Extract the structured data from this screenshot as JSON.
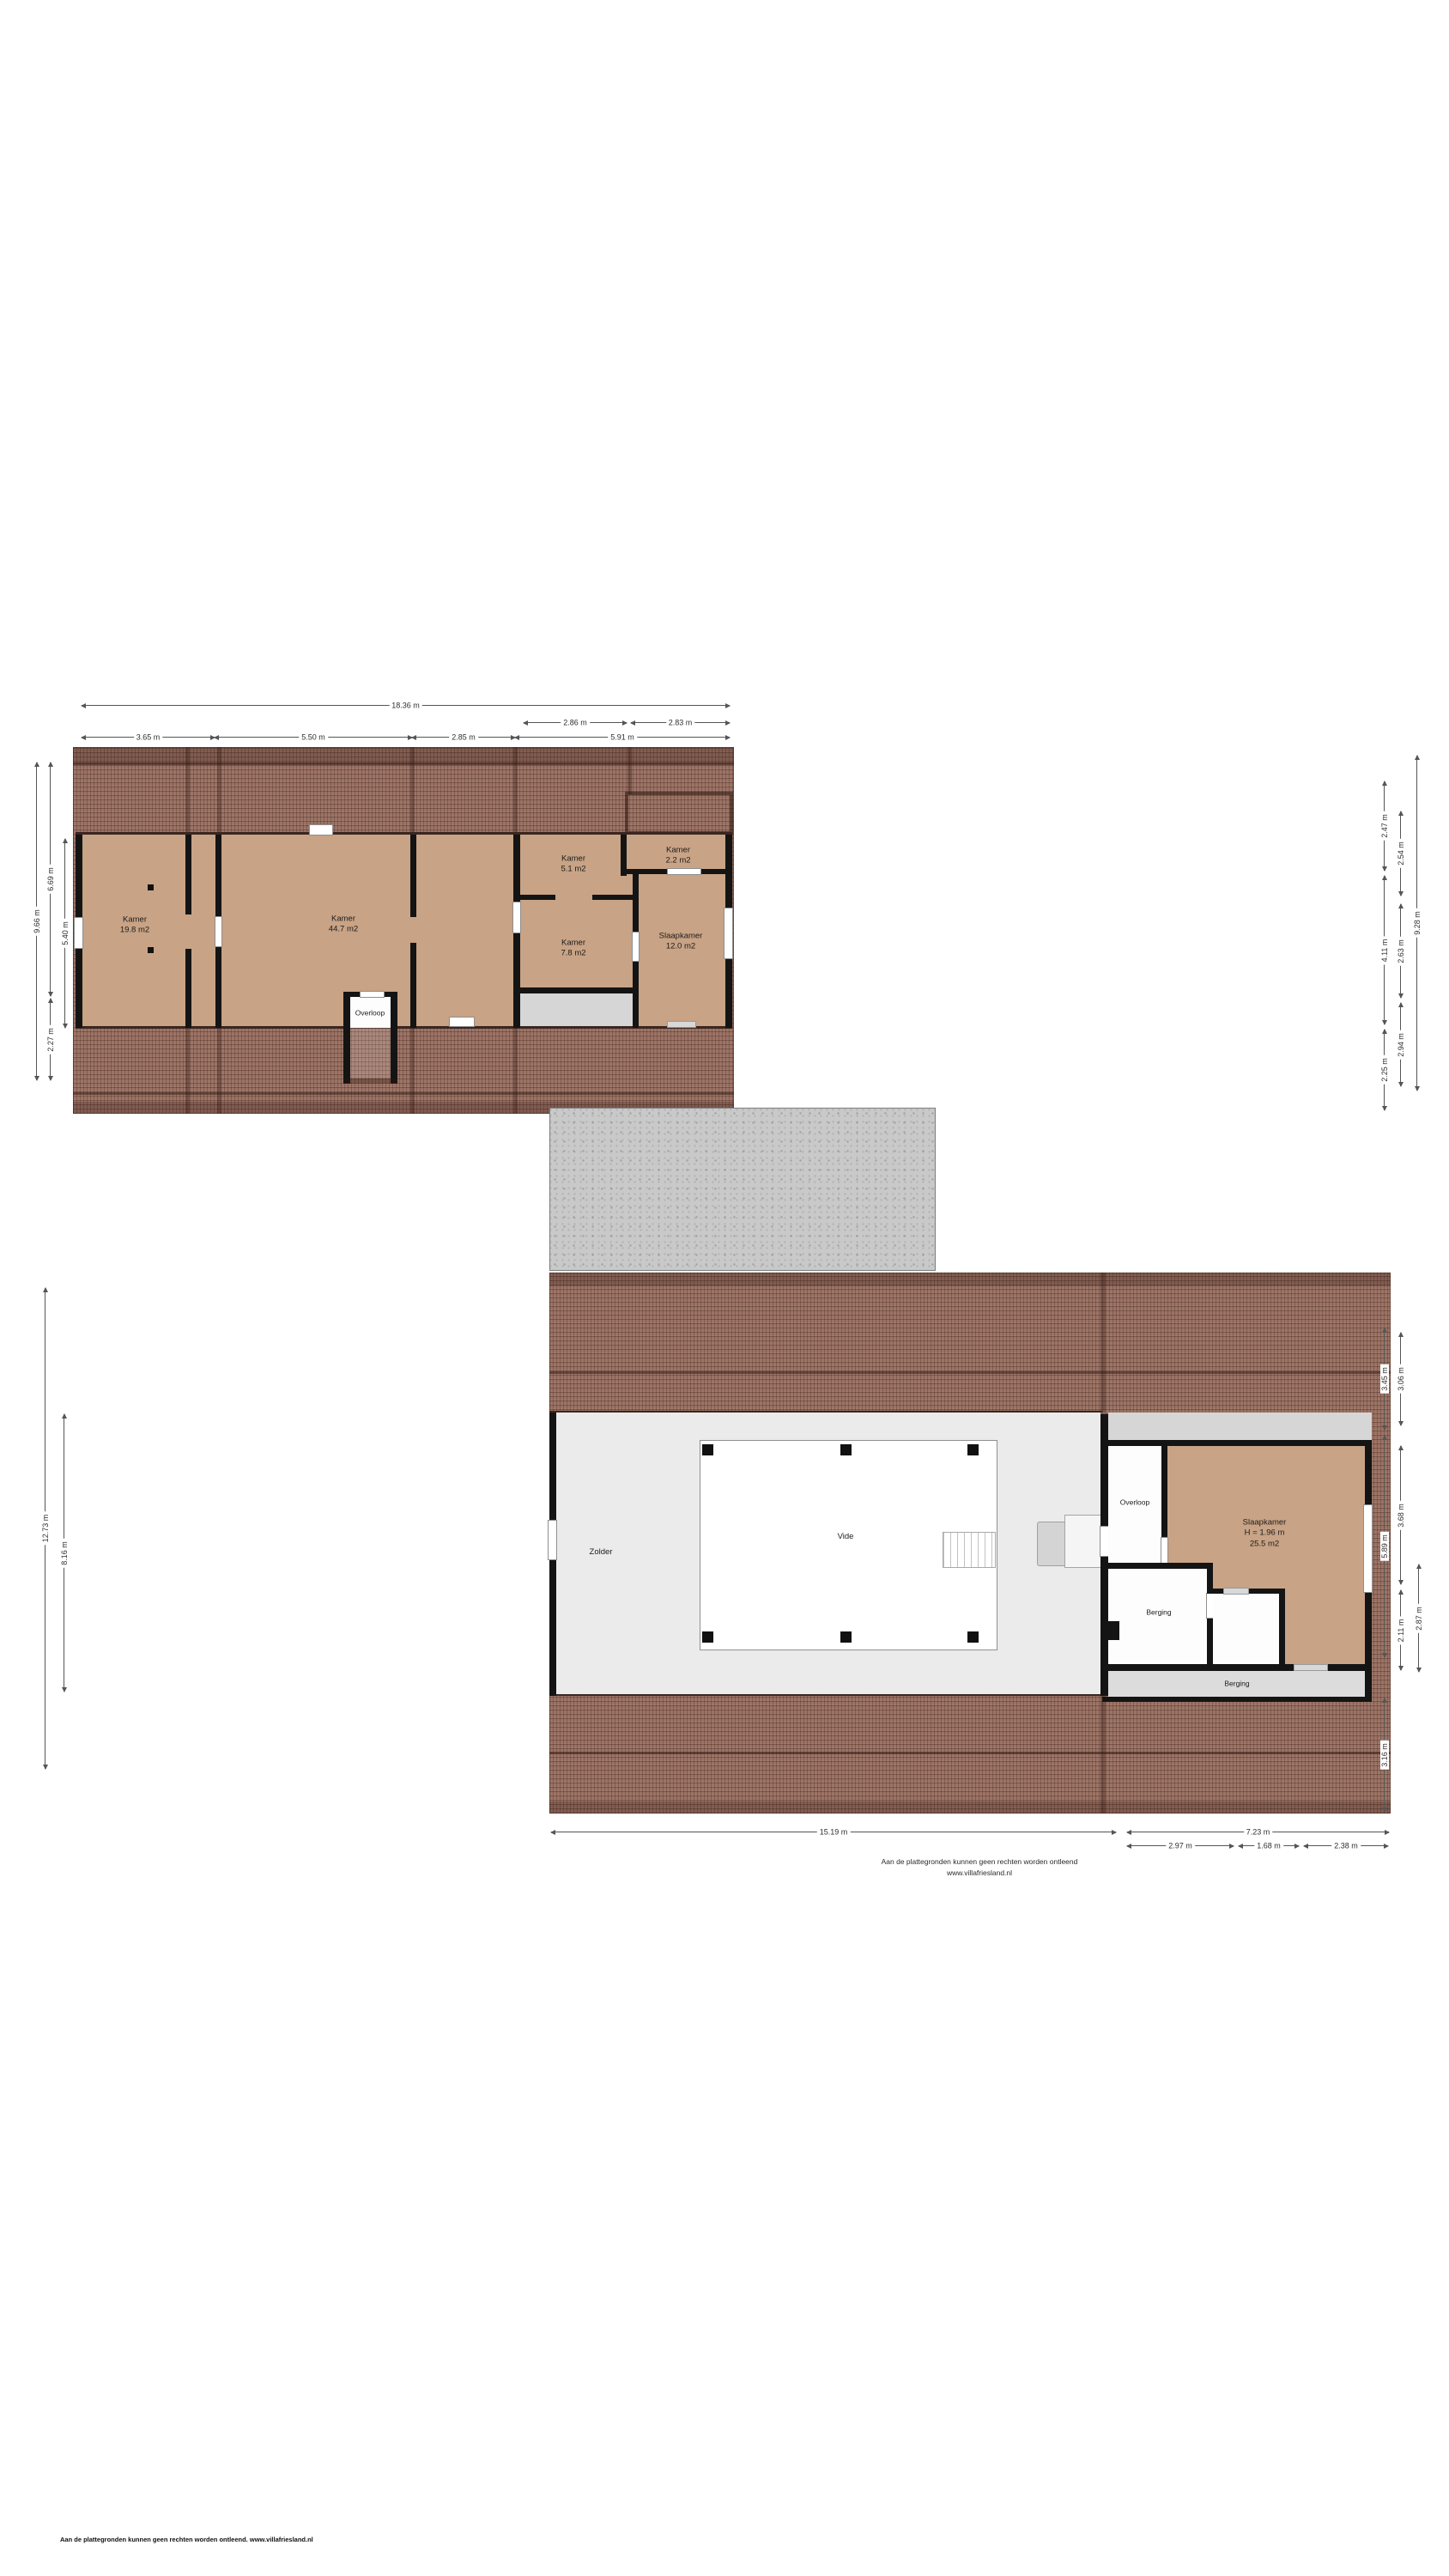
{
  "meta": {
    "roof_color": "#9b7365",
    "floor_tan": "#c8a385",
    "floor_gray": "#d6d6d6",
    "wall_color": "#141414"
  },
  "footer": {
    "disclaimer_line": "Aan de plattegronden kunnen geen rechten worden ontleend",
    "website": "www.villafriesland.nl",
    "page_footer": "Aan de plattegronden kunnen geen rechten worden ontleend. www.villafriesland.nl"
  },
  "floor1": {
    "rooms": {
      "kamer198": {
        "name": "Kamer",
        "area": "19.8 m2"
      },
      "kamer447": {
        "name": "Kamer",
        "area": "44.7 m2"
      },
      "kamer51": {
        "name": "Kamer",
        "area": "5.1 m2"
      },
      "kamer22": {
        "name": "Kamer",
        "area": "2.2 m2"
      },
      "kamer78": {
        "name": "Kamer",
        "area": "7.8 m2"
      },
      "slaapkamer": {
        "name": "Slaapkamer",
        "area": "12.0 m2"
      },
      "overloop": {
        "name": "Overloop"
      }
    },
    "dims": {
      "total_width": "18.36 m",
      "seg_286": "2.86 m",
      "seg_283": "2.83 m",
      "seg_365": "3.65 m",
      "seg_550": "5.50 m",
      "seg_285": "2.85 m",
      "seg_591": "5.91 m",
      "left_966": "9.66 m",
      "left_669": "6.69 m",
      "left_227": "2.27 m",
      "left_540": "5.40 m",
      "right_247": "2.47 m",
      "right_411": "4.11 m",
      "right_225": "2.25 m",
      "right_254": "2.54 m",
      "right_263": "2.63 m",
      "right_294": "2.94 m",
      "right_928": "9.28 m"
    }
  },
  "floor2": {
    "rooms": {
      "zolder": {
        "name": "Zolder"
      },
      "vide": {
        "name": "Vide"
      },
      "overloop": {
        "name": "Overloop"
      },
      "slaapkamer": {
        "name": "Slaapkamer",
        "height": "H = 1.96 m",
        "area": "25.5 m2"
      },
      "berging1": {
        "name": "Berging"
      },
      "berging2": {
        "name": "Berging"
      }
    },
    "dims": {
      "bottom_1519": "15.19 m",
      "bottom_723": "7.23 m",
      "bottom_297": "2.97 m",
      "bottom_168": "1.68 m",
      "bottom_238": "2.38 m",
      "left_1273": "12.73 m",
      "left_816": "8.16 m",
      "right_345": "3.45 m",
      "right_589": "5.89 m",
      "right_316": "3.16 m",
      "right_306": "3.06 m",
      "right_368": "3.68 m",
      "right_211": "2.11 m",
      "right_287": "2.87 m"
    }
  }
}
